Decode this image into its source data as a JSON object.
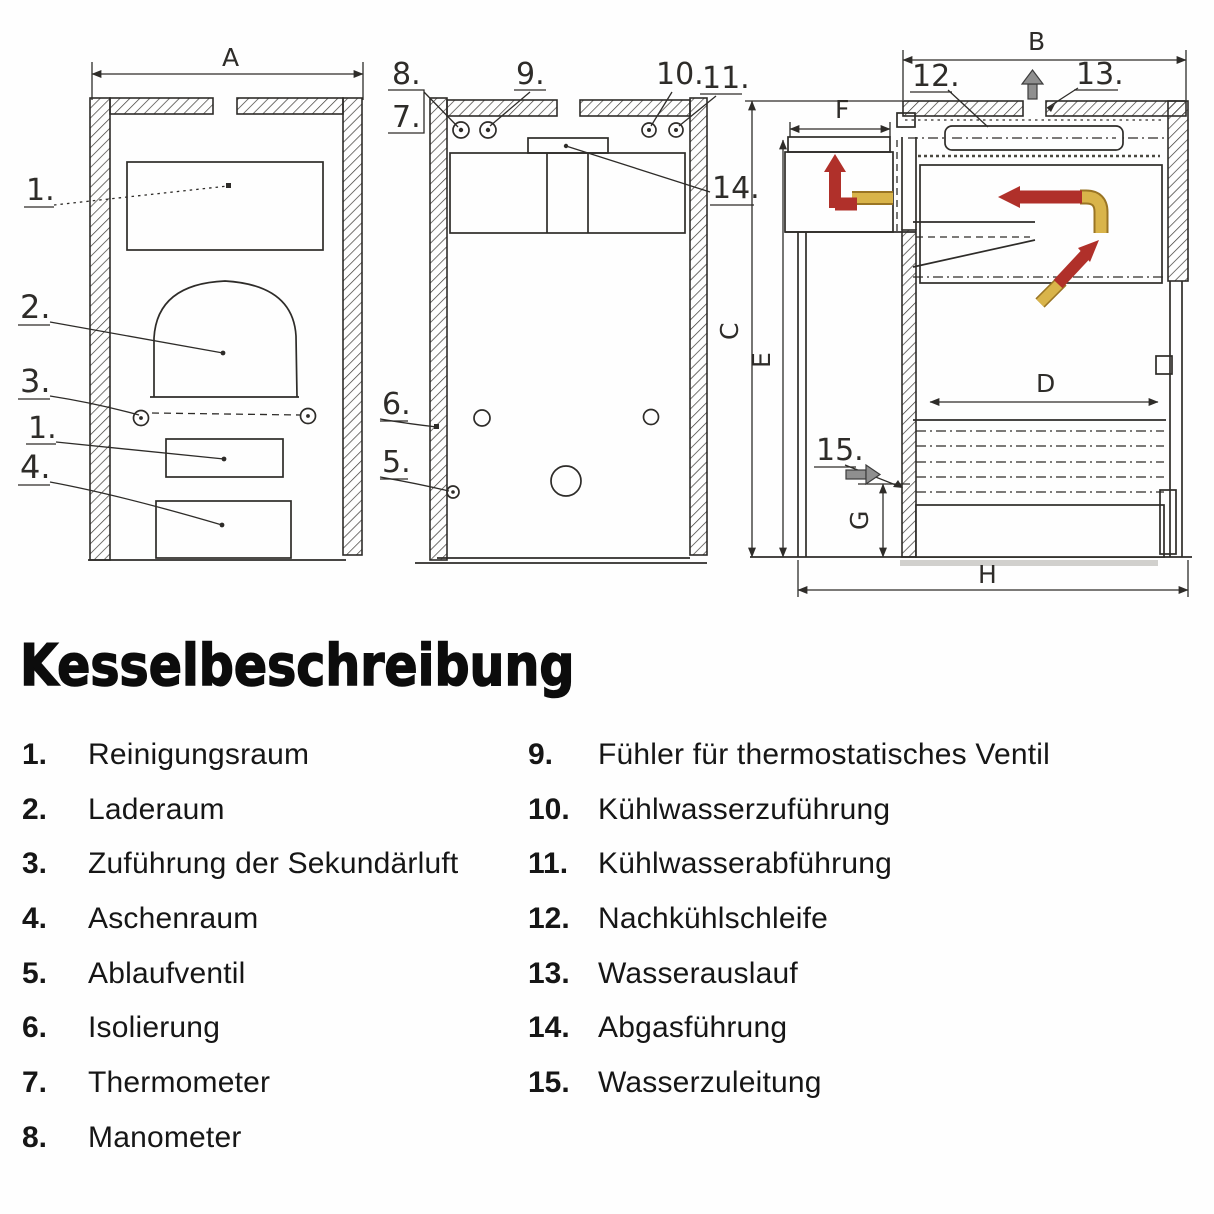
{
  "header": {
    "title": "Kesselbeschreibung"
  },
  "drawing": {
    "dims": {
      "A": "A",
      "B": "B",
      "C": "C",
      "D": "D",
      "E": "E",
      "F": "F",
      "G": "G",
      "H": "H"
    },
    "callouts": {
      "n1": "1.",
      "n2": "2.",
      "n3": "3.",
      "n4": "4.",
      "n5": "5.",
      "n6": "6.",
      "n7": "7.",
      "n8": "8.",
      "n9": "9.",
      "n10": "10.",
      "n11": "11.",
      "n12": "12.",
      "n13": "13.",
      "n14": "14.",
      "n15": "15."
    },
    "colors": {
      "ink": "#2e2c29",
      "hot_flow_red": "#b0302a",
      "warm_flow_yellow": "#d9b44a",
      "neutral_arrow_gray": "#8f8f8f"
    }
  },
  "legend": {
    "left": [
      {
        "num": "1.",
        "label": "Reinigungsraum"
      },
      {
        "num": "2.",
        "label": "Laderaum"
      },
      {
        "num": "3.",
        "label": "Zuführung der Sekundärluft"
      },
      {
        "num": "4.",
        "label": "Aschenraum"
      },
      {
        "num": "5.",
        "label": "Ablaufventil"
      },
      {
        "num": "6.",
        "label": "Isolierung"
      },
      {
        "num": "7.",
        "label": "Thermometer"
      },
      {
        "num": "8.",
        "label": "Manometer"
      }
    ],
    "right": [
      {
        "num": "9.",
        "label": "Fühler für thermostatisches Ventil"
      },
      {
        "num": "10.",
        "label": "Kühlwasserzuführung"
      },
      {
        "num": "11.",
        "label": "Kühlwasserabführung"
      },
      {
        "num": "12.",
        "label": "Nachkühlschleife"
      },
      {
        "num": "13.",
        "label": "Wasserauslauf"
      },
      {
        "num": "14.",
        "label": "Abgasführung"
      },
      {
        "num": "15.",
        "label": "Wasserzuleitung"
      }
    ]
  }
}
